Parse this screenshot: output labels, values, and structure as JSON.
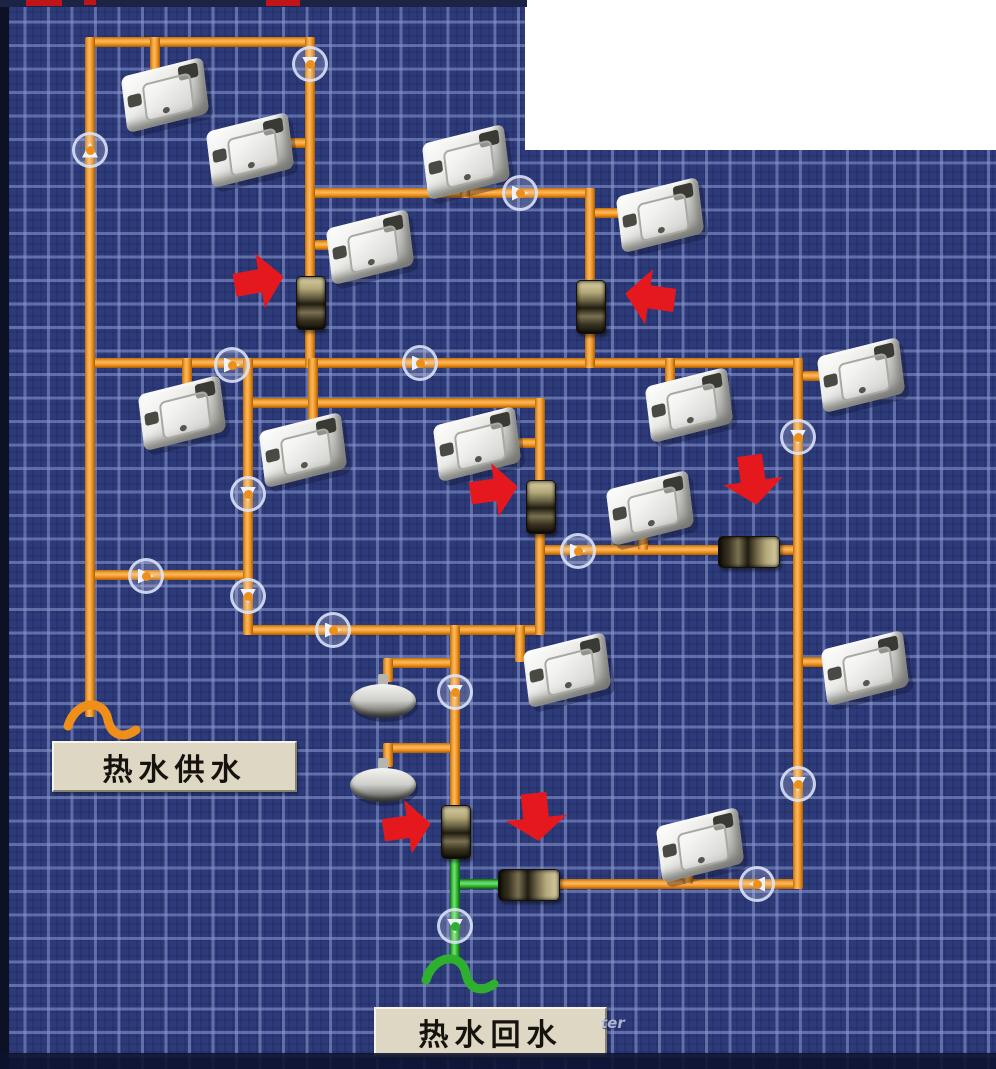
{
  "meta": {
    "screen_name": "hot-water-piping-hmi"
  },
  "labels": {
    "supply": "热水供水",
    "return": "热水回水",
    "watermark": "ter"
  },
  "colors": {
    "background": "#2e3b7b",
    "grid_line": "#8c9ad2",
    "pipe_supply": "#ef8f1a",
    "pipe_return": "#2eb02e",
    "alarm_arrow": "#e5191d",
    "flow_badge_ring": "#dee5fa",
    "label_bg": "#ddd7c3",
    "label_text": "#16120e",
    "cutout": "#ffffff"
  },
  "network": {
    "pipes": [
      {
        "o": "h",
        "x": 90,
        "y": 37,
        "l": 225,
        "c": "s"
      },
      {
        "o": "h",
        "x": 310,
        "y": 188,
        "l": 285,
        "c": "s"
      },
      {
        "o": "h",
        "x": 90,
        "y": 358,
        "l": 713,
        "c": "s"
      },
      {
        "o": "h",
        "x": 248,
        "y": 398,
        "l": 297,
        "c": "s"
      },
      {
        "o": "h",
        "x": 540,
        "y": 545,
        "l": 263,
        "c": "s"
      },
      {
        "o": "h",
        "x": 248,
        "y": 625,
        "l": 297,
        "c": "s"
      },
      {
        "o": "h",
        "x": 90,
        "y": 570,
        "l": 163,
        "c": "s"
      },
      {
        "o": "h",
        "x": 556,
        "y": 879,
        "l": 247,
        "c": "s"
      },
      {
        "o": "h",
        "x": 450,
        "y": 879,
        "l": 60,
        "c": "r"
      },
      {
        "o": "h",
        "x": 388,
        "y": 658,
        "l": 72,
        "c": "s"
      },
      {
        "o": "h",
        "x": 388,
        "y": 743,
        "l": 72,
        "c": "s"
      },
      {
        "o": "h",
        "x": 283,
        "y": 138,
        "l": 32,
        "c": "s"
      },
      {
        "o": "h",
        "x": 315,
        "y": 240,
        "l": 25,
        "c": "s"
      },
      {
        "o": "h",
        "x": 595,
        "y": 208,
        "l": 33,
        "c": "s"
      },
      {
        "o": "h",
        "x": 510,
        "y": 438,
        "l": 35,
        "c": "s"
      },
      {
        "o": "h",
        "x": 803,
        "y": 371,
        "l": 22,
        "c": "s"
      },
      {
        "o": "h",
        "x": 803,
        "y": 657,
        "l": 28,
        "c": "s"
      },
      {
        "o": "v",
        "x": 85,
        "y": 37,
        "l": 680,
        "c": "s"
      },
      {
        "o": "v",
        "x": 305,
        "y": 37,
        "l": 331,
        "c": "s"
      },
      {
        "o": "v",
        "x": 585,
        "y": 188,
        "l": 180,
        "c": "s"
      },
      {
        "o": "v",
        "x": 793,
        "y": 358,
        "l": 531,
        "c": "s"
      },
      {
        "o": "v",
        "x": 243,
        "y": 358,
        "l": 277,
        "c": "s"
      },
      {
        "o": "v",
        "x": 535,
        "y": 398,
        "l": 237,
        "c": "s"
      },
      {
        "o": "v",
        "x": 450,
        "y": 625,
        "l": 223,
        "c": "s"
      },
      {
        "o": "v",
        "x": 450,
        "y": 840,
        "l": 122,
        "c": "r"
      },
      {
        "o": "v",
        "x": 150,
        "y": 37,
        "l": 43,
        "c": "s"
      },
      {
        "o": "v",
        "x": 460,
        "y": 170,
        "l": 28,
        "c": "s"
      },
      {
        "o": "v",
        "x": 182,
        "y": 358,
        "l": 34,
        "c": "s"
      },
      {
        "o": "v",
        "x": 308,
        "y": 358,
        "l": 72,
        "c": "s"
      },
      {
        "o": "v",
        "x": 665,
        "y": 358,
        "l": 24,
        "c": "s"
      },
      {
        "o": "v",
        "x": 638,
        "y": 513,
        "l": 37,
        "c": "s"
      },
      {
        "o": "v",
        "x": 515,
        "y": 625,
        "l": 37,
        "c": "s"
      },
      {
        "o": "v",
        "x": 683,
        "y": 863,
        "l": 21,
        "c": "s"
      },
      {
        "o": "v",
        "x": 383,
        "y": 658,
        "l": 24,
        "c": "s"
      },
      {
        "o": "v",
        "x": 383,
        "y": 743,
        "l": 24,
        "c": "s"
      }
    ],
    "breaks": [
      {
        "x": 58,
        "y": 694,
        "c": "s"
      },
      {
        "x": 416,
        "y": 948,
        "c": "r"
      }
    ],
    "sinks": [
      [
        123,
        67
      ],
      [
        208,
        122
      ],
      [
        424,
        134
      ],
      [
        618,
        187
      ],
      [
        328,
        219
      ],
      [
        140,
        385
      ],
      [
        261,
        422
      ],
      [
        435,
        416
      ],
      [
        819,
        347
      ],
      [
        647,
        377
      ],
      [
        608,
        480
      ],
      [
        525,
        642
      ],
      [
        823,
        640
      ],
      [
        658,
        817
      ]
    ],
    "showers": [
      [
        350,
        682
      ],
      [
        350,
        766
      ]
    ],
    "valves": [
      {
        "x": 296,
        "y": 276,
        "o": "v"
      },
      {
        "x": 576,
        "y": 280,
        "o": "v"
      },
      {
        "x": 526,
        "y": 480,
        "o": "v"
      },
      {
        "x": 718,
        "y": 536,
        "o": "h"
      },
      {
        "x": 441,
        "y": 805,
        "o": "v"
      },
      {
        "x": 498,
        "y": 869,
        "o": "h"
      }
    ],
    "flow_arrows": [
      {
        "x": 310,
        "y": 64,
        "d": "down",
        "c": "s"
      },
      {
        "x": 90,
        "y": 150,
        "d": "up",
        "c": "s"
      },
      {
        "x": 520,
        "y": 193,
        "d": "right",
        "c": "s"
      },
      {
        "x": 232,
        "y": 365,
        "d": "right",
        "c": "s"
      },
      {
        "x": 420,
        "y": 363,
        "d": "right",
        "c": "s"
      },
      {
        "x": 798,
        "y": 437,
        "d": "down",
        "c": "s"
      },
      {
        "x": 248,
        "y": 494,
        "d": "down",
        "c": "s"
      },
      {
        "x": 146,
        "y": 576,
        "d": "right",
        "c": "s"
      },
      {
        "x": 248,
        "y": 596,
        "d": "down",
        "c": "s"
      },
      {
        "x": 333,
        "y": 630,
        "d": "right",
        "c": "s"
      },
      {
        "x": 798,
        "y": 784,
        "d": "down",
        "c": "s"
      },
      {
        "x": 757,
        "y": 884,
        "d": "left",
        "c": "s"
      },
      {
        "x": 455,
        "y": 692,
        "d": "down",
        "c": "s"
      },
      {
        "x": 455,
        "y": 926,
        "d": "down",
        "c": "r"
      },
      {
        "x": 578,
        "y": 551,
        "d": "right",
        "c": "s"
      }
    ],
    "alarm_arrows": [
      {
        "x": 234,
        "y": 252,
        "w": 50,
        "h": 58,
        "d": "right",
        "r": -10
      },
      {
        "x": 625,
        "y": 268,
        "w": 50,
        "h": 58,
        "d": "left",
        "r": 8
      },
      {
        "x": 470,
        "y": 462,
        "w": 48,
        "h": 56,
        "d": "right",
        "r": -8
      },
      {
        "x": 722,
        "y": 455,
        "w": 62,
        "h": 50,
        "d": "down",
        "r": -8
      },
      {
        "x": 383,
        "y": 799,
        "w": 48,
        "h": 56,
        "d": "right",
        "r": -8
      },
      {
        "x": 504,
        "y": 793,
        "w": 64,
        "h": 48,
        "d": "down",
        "r": -6
      }
    ]
  },
  "overlay": {
    "cutout": {
      "x": 525,
      "y": 0,
      "w": 471,
      "h": 150
    },
    "supply_label_box": {
      "x": 52,
      "y": 741,
      "w": 241,
      "h": 47
    },
    "return_label_box": {
      "x": 374,
      "y": 1007,
      "w": 229,
      "h": 46
    },
    "watermark_pos": {
      "x": 600,
      "y": 1014
    },
    "top_specks": [
      [
        26,
        0,
        36,
        6
      ],
      [
        84,
        0,
        12,
        5
      ],
      [
        266,
        0,
        34,
        6
      ]
    ]
  }
}
